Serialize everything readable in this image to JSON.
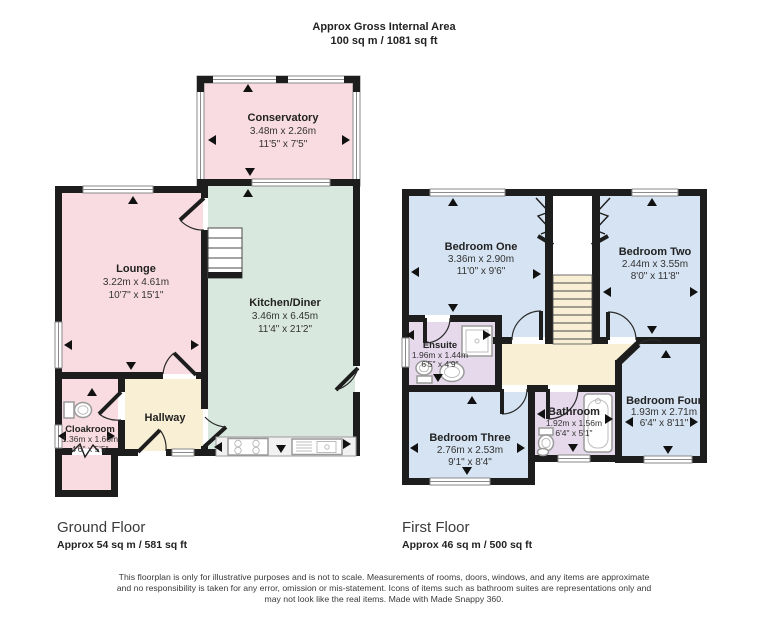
{
  "header": {
    "line1": "Approx Gross Internal Area",
    "line2": "100 sq m / 1081 sq ft"
  },
  "ground": {
    "floor_label": "Ground Floor",
    "floor_area": "Approx 54 sq m / 581 sq ft",
    "conservatory": {
      "name": "Conservatory",
      "metric": "3.48m x 2.26m",
      "imperial": "11'5\" x 7'5\""
    },
    "lounge": {
      "name": "Lounge",
      "metric": "3.22m x 4.61m",
      "imperial": "10'7\" x 15'1\""
    },
    "kitchen": {
      "name": "Kitchen/Diner",
      "metric": "3.46m x 6.45m",
      "imperial": "11'4\" x 21'2\""
    },
    "hallway": {
      "name": "Hallway"
    },
    "cloakroom": {
      "name": "Cloakroom",
      "metric": "1.36m x 1.66m",
      "imperial": "4'6\" x 5'5\""
    }
  },
  "first": {
    "floor_label": "First Floor",
    "floor_area": "Approx 46 sq m / 500 sq ft",
    "bedroom_one": {
      "name": "Bedroom One",
      "metric": "3.36m x 2.90m",
      "imperial": "11'0\" x 9'6\""
    },
    "bedroom_two": {
      "name": "Bedroom Two",
      "metric": "2.44m x 3.55m",
      "imperial": "8'0\" x 11'8\""
    },
    "ensuite": {
      "name": "Ensuite",
      "metric": "1.96m x 1.44m",
      "imperial": "6'5\" x 4'9\""
    },
    "bedroom_three": {
      "name": "Bedroom Three",
      "metric": "2.76m x 2.53m",
      "imperial": "9'1\" x 8'4\""
    },
    "bathroom": {
      "name": "Bathroom",
      "metric": "1.92m x 1.56m",
      "imperial": "6'4\" x 5'1\""
    },
    "bedroom_four": {
      "name": "Bedroom Four",
      "metric": "1.93m x 2.71m",
      "imperial": "6'4\" x 8'11\""
    }
  },
  "footer": {
    "line1": "This floorplan is only for illustrative purposes and is not to scale. Measurements of rooms, doors, windows, and any items are approximate",
    "line2": "and no responsibility is taken for any error, omission or mis-statement. Icons of items such as bathroom suites are representations only and",
    "line3": "may not look like the real items. Made with Made Snappy 360."
  },
  "icons": [
    "toilet-icon",
    "sink-icon",
    "shower-icon",
    "bathtub-icon",
    "stove-icon",
    "kitchen-sink-icon",
    "stairs-icon",
    "door-arc-icon",
    "window-icon",
    "measure-arrow-icon"
  ],
  "colors": {
    "room_pink": "#f9dce1",
    "room_green": "#d9e8df",
    "room_cream": "#f8efd5",
    "room_blue": "#d5e3f2",
    "room_lavender": "#e6d9ec",
    "wall": "#1d1d1d",
    "fixture_gray": "#9a9a9a"
  }
}
